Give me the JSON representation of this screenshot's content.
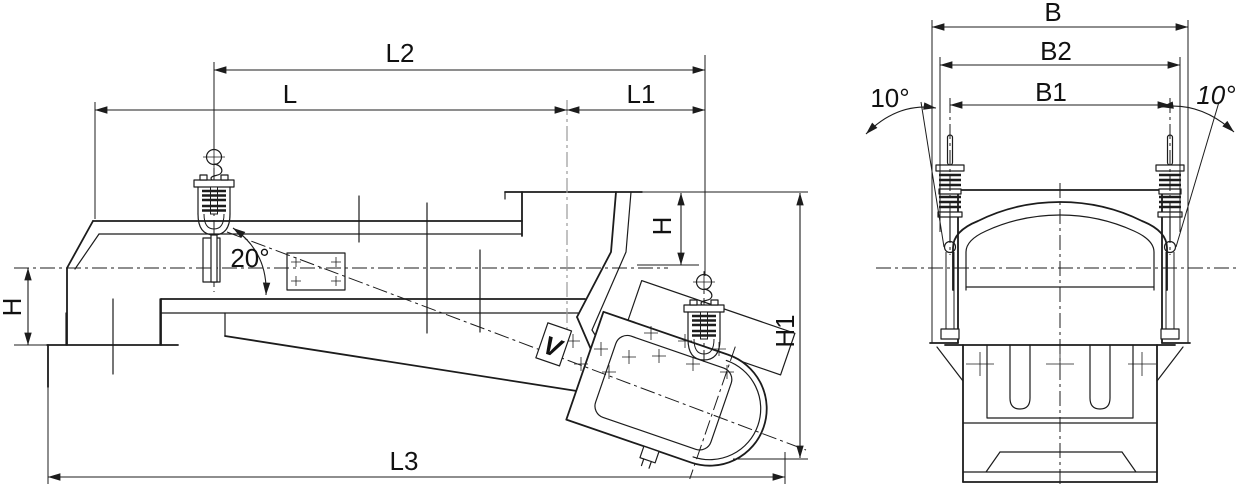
{
  "drawing": {
    "type": "technical-dimension-drawing",
    "subject": "suspended vibrating feeder, side elevation and end view",
    "background_color": "#ffffff",
    "line_color": "#1c1c1c",
    "dims": {
      "l2": "L2",
      "l": "L",
      "l1": "L1",
      "l3": "L3",
      "h_left": "H",
      "h_right": "H",
      "h1": "H1",
      "angle_trough": "20°",
      "b": "B",
      "b2": "B2",
      "b1": "B1",
      "angle_hanger_left": "10°",
      "angle_hanger_right": "10°",
      "marker_v": "V"
    }
  }
}
